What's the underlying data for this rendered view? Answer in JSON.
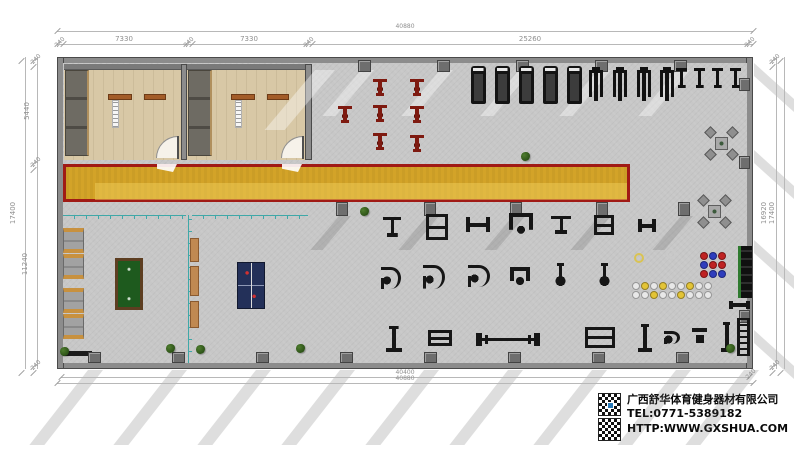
{
  "company": {
    "name": "广西舒华体育健身器材有限公司",
    "tel": "TEL:0771-5389182",
    "web": "HTTP:WWW.GXSHUA.COM"
  },
  "colors": {
    "track_fill": "#d4a01c",
    "track_border": "#a01a15",
    "floor": "#c7c7c7",
    "wood": "#d8c8a6",
    "teal_partition": "#3fa8a8",
    "pool_felt": "#1e5a1e",
    "pingpong": "#233059",
    "spin_bike": "#7e1a10",
    "locker_accent": "#c8913f"
  },
  "dimensions": {
    "top": {
      "line1": {
        "y": 31,
        "x1": 57,
        "x2": 753,
        "label": "40880",
        "lx": 405
      },
      "line2": {
        "y": 44,
        "x1": 57,
        "x2": 753,
        "ticks": [
          57,
          63,
          186,
          192,
          306,
          312,
          747,
          753
        ],
        "labels": [
          {
            "t": "240",
            "x": 60,
            "s": 1
          },
          {
            "t": "7330",
            "x": 124
          },
          {
            "t": "240",
            "x": 189,
            "s": 1
          },
          {
            "t": "7330",
            "x": 249
          },
          {
            "t": "240",
            "x": 309,
            "s": 1
          },
          {
            "t": "25260",
            "x": 530
          },
          {
            "t": "240",
            "x": 750,
            "s": 1
          }
        ]
      }
    },
    "bottom": {
      "line1": {
        "y": 377,
        "x1": 61,
        "x2": 749,
        "label": "40400",
        "lx": 405
      },
      "line2": {
        "y": 383,
        "x1": 57,
        "x2": 753,
        "label": "40880",
        "lx": 405
      },
      "corner_labels": [
        {
          "t": "240",
          "x": 751,
          "y": 375
        }
      ]
    },
    "left": {
      "outer": {
        "x": 25,
        "y1": 57,
        "y2": 369,
        "label": "17400",
        "ly": 213
      },
      "inner": {
        "x": 37,
        "ticks": [
          57,
          63,
          160,
          166,
          363,
          369
        ],
        "labels": [
          {
            "t": "240",
            "y": 60,
            "s": 1
          },
          {
            "t": "5440",
            "y": 111
          },
          {
            "t": "240",
            "y": 163,
            "s": 1
          },
          {
            "t": "11240",
            "y": 264
          },
          {
            "t": "240",
            "y": 366,
            "s": 1
          }
        ]
      }
    },
    "right": {
      "outer": {
        "x": 784,
        "y1": 57,
        "y2": 369,
        "label": "17400",
        "ly": 213
      },
      "inner": {
        "x": 776,
        "ticks": [
          57,
          63,
          363,
          369
        ],
        "labels": [
          {
            "t": "240",
            "y": 60,
            "s": 1
          },
          {
            "t": "16920",
            "y": 213
          },
          {
            "t": "240",
            "y": 366,
            "s": 1
          }
        ]
      }
    }
  },
  "floor": {
    "equipment": [
      {
        "t": "treadmill",
        "x": 471,
        "y": 66,
        "w": 15,
        "h": 38
      },
      {
        "t": "treadmill",
        "x": 495,
        "y": 66,
        "w": 15,
        "h": 38
      },
      {
        "t": "treadmill",
        "x": 519,
        "y": 66,
        "w": 15,
        "h": 38
      },
      {
        "t": "treadmill",
        "x": 543,
        "y": 66,
        "w": 15,
        "h": 38
      },
      {
        "t": "treadmill",
        "x": 567,
        "y": 66,
        "w": 15,
        "h": 38
      },
      {
        "t": "elliptical",
        "x": 589,
        "y": 67,
        "w": 14,
        "h": 34
      },
      {
        "t": "elliptical",
        "x": 613,
        "y": 67,
        "w": 14,
        "h": 34
      },
      {
        "t": "elliptical",
        "x": 637,
        "y": 67,
        "w": 14,
        "h": 34
      },
      {
        "t": "elliptical",
        "x": 660,
        "y": 67,
        "w": 14,
        "h": 34
      },
      {
        "t": "bike",
        "x": 676,
        "y": 68,
        "w": 11,
        "h": 20
      },
      {
        "t": "bike",
        "x": 694,
        "y": 68,
        "w": 11,
        "h": 20
      },
      {
        "t": "bike",
        "x": 712,
        "y": 68,
        "w": 11,
        "h": 20
      },
      {
        "t": "bike",
        "x": 730,
        "y": 68,
        "w": 11,
        "h": 20
      },
      {
        "t": "spin",
        "x": 373,
        "y": 79,
        "w": 14,
        "h": 17
      },
      {
        "t": "spin",
        "x": 410,
        "y": 79,
        "w": 14,
        "h": 17
      },
      {
        "t": "spin",
        "x": 338,
        "y": 106,
        "w": 14,
        "h": 17
      },
      {
        "t": "spin",
        "x": 373,
        "y": 105,
        "w": 14,
        "h": 17
      },
      {
        "t": "spin",
        "x": 410,
        "y": 106,
        "w": 14,
        "h": 17
      },
      {
        "t": "spin",
        "x": 373,
        "y": 133,
        "w": 14,
        "h": 17
      },
      {
        "t": "spin",
        "x": 410,
        "y": 135,
        "w": 14,
        "h": 17
      },
      {
        "t": "lat",
        "x": 383,
        "y": 217,
        "w": 18,
        "h": 20
      },
      {
        "t": "frame",
        "x": 426,
        "y": 214,
        "w": 22,
        "h": 26
      },
      {
        "t": "bench",
        "x": 466,
        "y": 217,
        "w": 24,
        "h": 15
      },
      {
        "t": "tower",
        "x": 509,
        "y": 213,
        "w": 24,
        "h": 24
      },
      {
        "t": "lat",
        "x": 551,
        "y": 216,
        "w": 20,
        "h": 18
      },
      {
        "t": "frame",
        "x": 594,
        "y": 215,
        "w": 20,
        "h": 20
      },
      {
        "t": "bench",
        "x": 638,
        "y": 219,
        "w": 18,
        "h": 13
      },
      {
        "t": "curl",
        "x": 381,
        "y": 267,
        "w": 20,
        "h": 22
      },
      {
        "t": "curl",
        "x": 423,
        "y": 265,
        "w": 22,
        "h": 24
      },
      {
        "t": "curl",
        "x": 468,
        "y": 265,
        "w": 22,
        "h": 22
      },
      {
        "t": "tower",
        "x": 510,
        "y": 267,
        "w": 20,
        "h": 20
      },
      {
        "t": "ped",
        "x": 553,
        "y": 263,
        "w": 15,
        "h": 24
      },
      {
        "t": "ped",
        "x": 597,
        "y": 263,
        "w": 15,
        "h": 24
      },
      {
        "t": "post",
        "x": 386,
        "y": 326,
        "w": 16,
        "h": 26
      },
      {
        "t": "frame",
        "x": 428,
        "y": 330,
        "w": 24,
        "h": 16
      },
      {
        "t": "barbell",
        "x": 476,
        "y": 333,
        "w": 64,
        "h": 13
      },
      {
        "t": "frame",
        "x": 585,
        "y": 327,
        "w": 30,
        "h": 21
      },
      {
        "t": "post",
        "x": 638,
        "y": 324,
        "w": 14,
        "h": 28
      },
      {
        "t": "curl",
        "x": 664,
        "y": 331,
        "w": 16,
        "h": 13
      },
      {
        "t": "chair",
        "x": 692,
        "y": 328,
        "w": 15,
        "h": 18
      },
      {
        "t": "post",
        "x": 721,
        "y": 322,
        "w": 12,
        "h": 30
      },
      {
        "t": "ladder",
        "x": 737,
        "y": 318,
        "w": 13,
        "h": 38
      },
      {
        "t": "rackwall",
        "x": 738,
        "y": 246,
        "w": 14,
        "h": 52
      },
      {
        "t": "bench",
        "x": 729,
        "y": 301,
        "w": 21,
        "h": 8
      }
    ],
    "columns": {
      "top": [
        358,
        437,
        516,
        595,
        674
      ],
      "track": [
        336,
        424,
        510,
        596,
        678
      ],
      "bottom": [
        88,
        172,
        256,
        340,
        424,
        508,
        592,
        676
      ],
      "right": [
        78,
        156,
        310
      ]
    },
    "shadows": {
      "bottom_xs": [
        88,
        172,
        256,
        340,
        424,
        508,
        592,
        676,
        744
      ],
      "right_ys": [
        63,
        150,
        240,
        330
      ]
    },
    "sofa_ys": [
      228,
      254,
      288,
      314
    ],
    "benches": [
      {
        "y": 238,
        "h": 24
      },
      {
        "y": 266,
        "h": 30
      },
      {
        "y": 301,
        "h": 27
      }
    ],
    "tables": [
      [
        706,
        128
      ],
      [
        699,
        196
      ]
    ],
    "plants": [
      [
        521,
        152
      ],
      [
        360,
        207
      ],
      [
        60,
        347
      ],
      [
        166,
        344
      ],
      [
        196,
        345
      ],
      [
        296,
        344
      ],
      [
        726,
        344
      ]
    ],
    "ball_grid": {
      "x": 700,
      "y": 252,
      "cell": 9,
      "colors": [
        [
          "#bf2222",
          "#2e3dbd",
          "#bf2222"
        ],
        [
          "#2e3dbd",
          "#bf2222",
          "#bf2222"
        ],
        [
          "#bf2222",
          "#2e3dbd",
          "#2e3dbd"
        ]
      ]
    },
    "ball_rows": {
      "x": 632,
      "y": 282,
      "cell": 9,
      "rows": [
        [
          "#e8e8e8",
          "#e3c436",
          "#e8e8e8",
          "#e3c436",
          "#e8e8e8",
          "#e8e8e8",
          "#e3c436",
          "#e8e8e8",
          "#e8e8e8"
        ],
        [
          "#e8e8e8",
          "#e8e8e8",
          "#e3c436",
          "#e8e8e8",
          "#e8e8e8",
          "#e3c436",
          "#e8e8e8",
          "#e8e8e8",
          "#e8e8e8"
        ]
      ]
    },
    "rings": [
      {
        "x": 634,
        "y": 253,
        "c": "#d9c353"
      },
      {
        "x": 666,
        "y": 249,
        "c": "#c9c9c9"
      }
    ]
  }
}
